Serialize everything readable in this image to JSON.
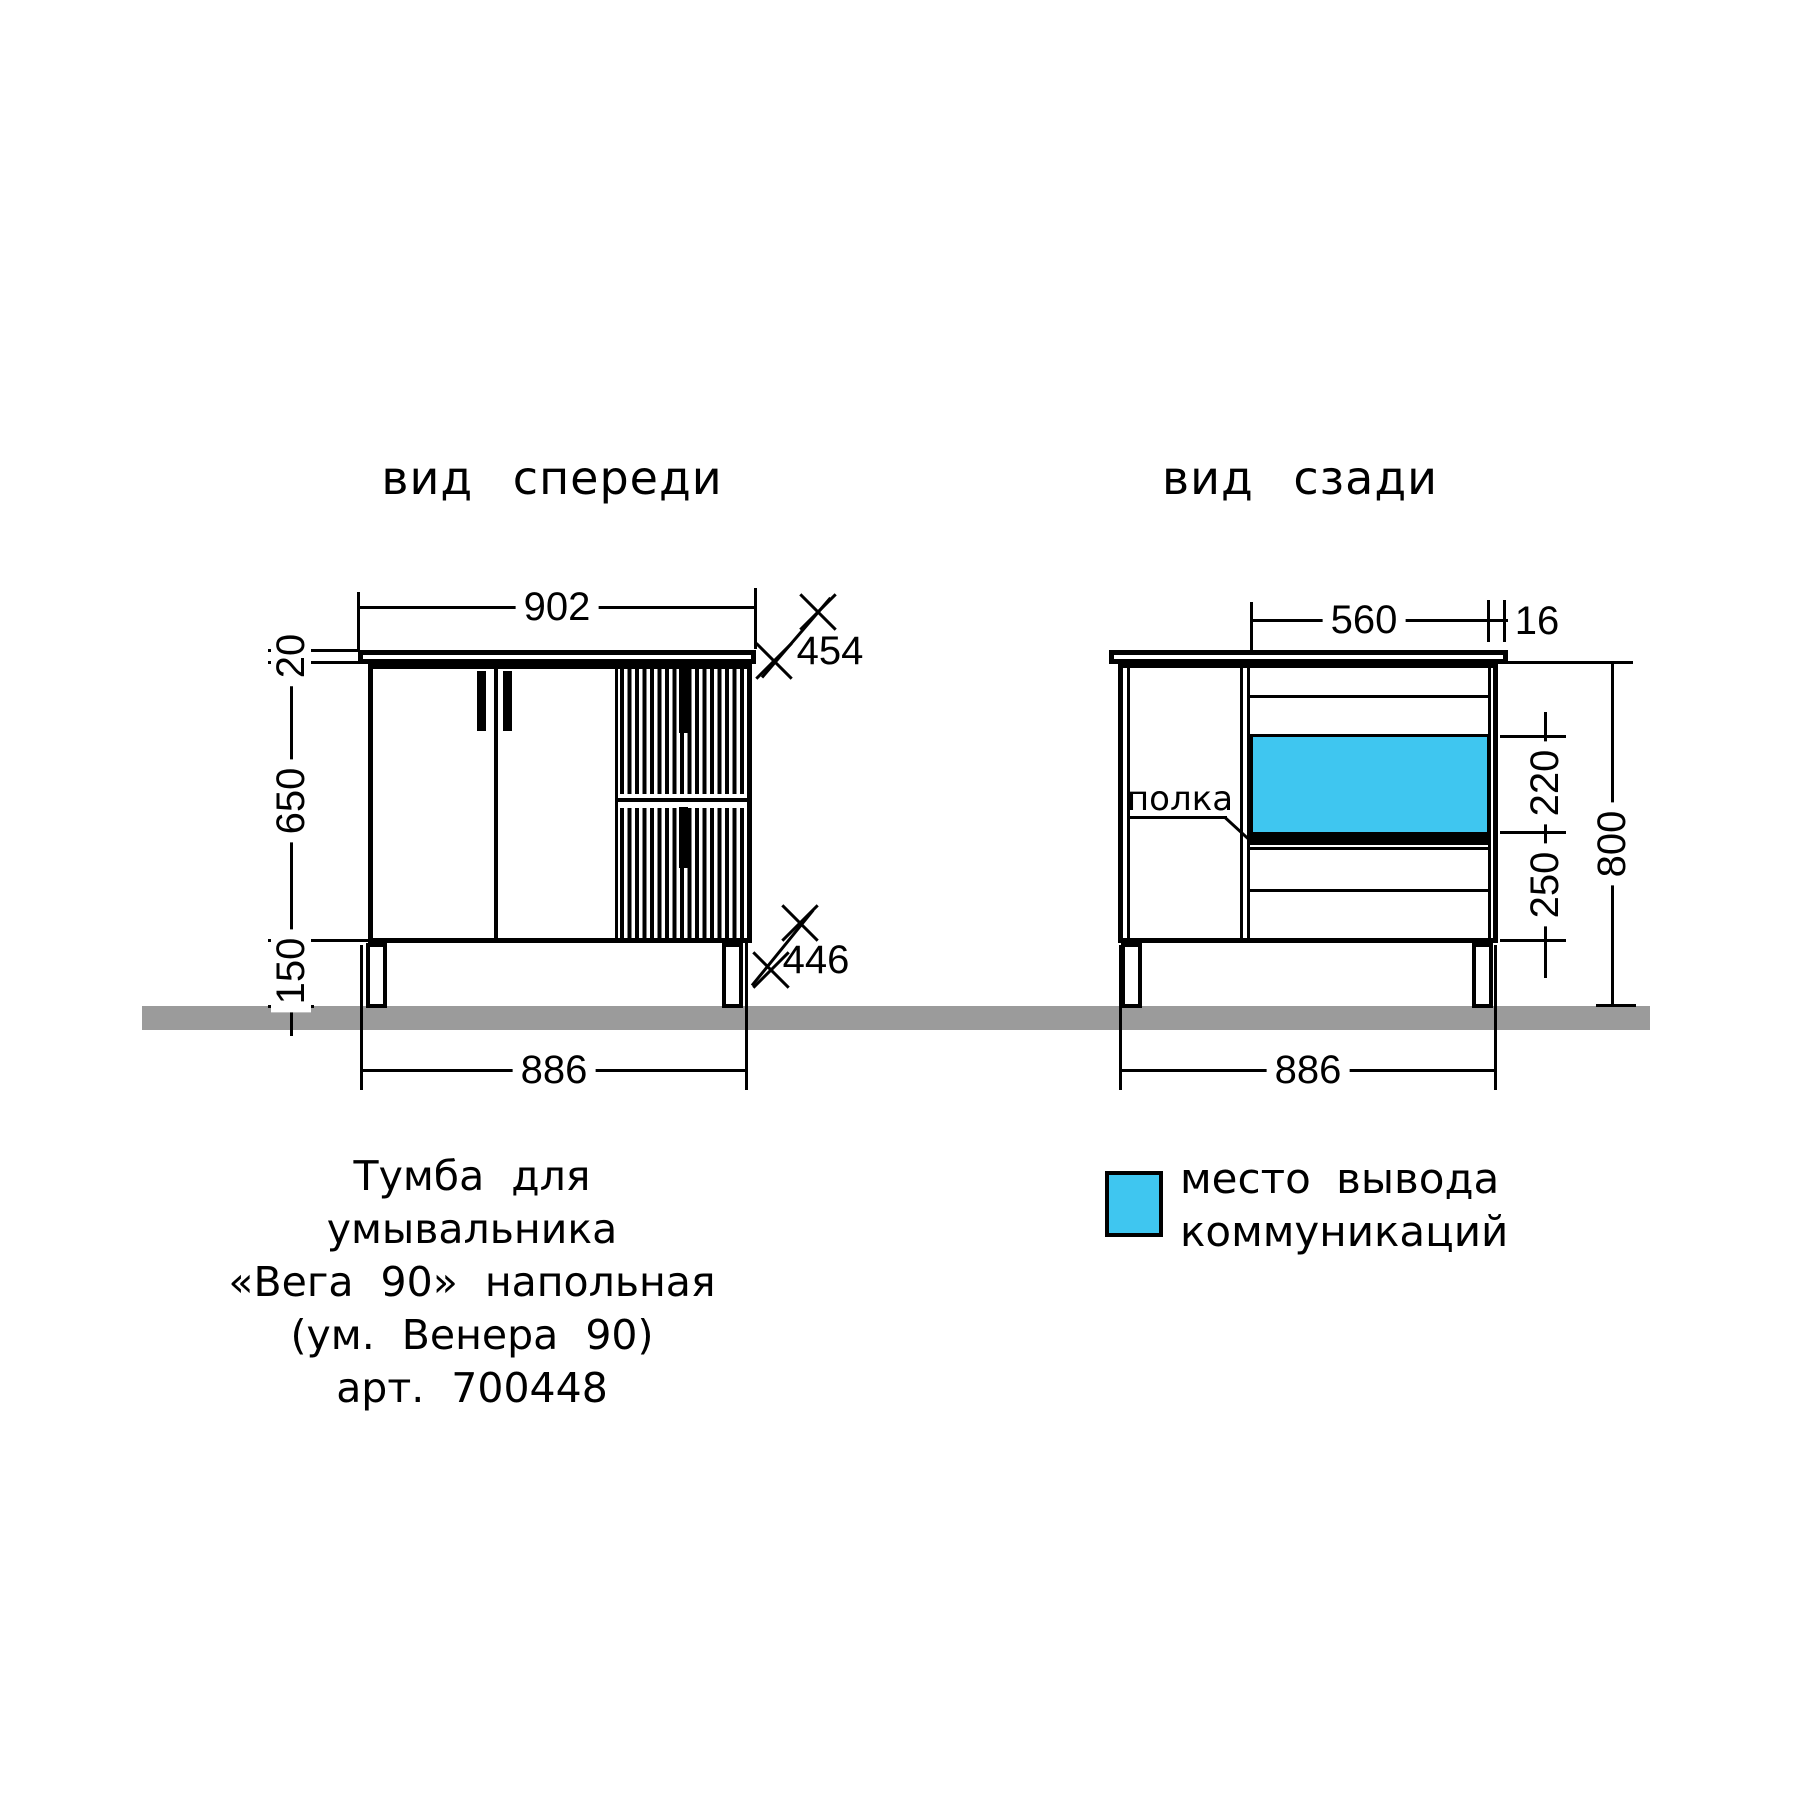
{
  "front": {
    "title": "вид спереди",
    "dims": {
      "top_width": "902",
      "countertop_thickness": "20",
      "body_height": "650",
      "leg_height": "150",
      "bottom_width": "886",
      "diag_top": "454",
      "diag_bottom": "446"
    }
  },
  "rear": {
    "title": "вид сзади",
    "shelf_label": "полка",
    "dims": {
      "inner_width": "560",
      "panel_thickness": "16",
      "comm_zone_height": "220",
      "bottom_zone_height": "250",
      "overall_height": "800",
      "bottom_width": "886"
    }
  },
  "caption": {
    "line1": "Тумба для умывальника",
    "line2": "«Вега 90» напольная",
    "line3": "(ум. Венера 90)",
    "line4": "арт. 700448"
  },
  "legend": {
    "line1": "место вывода",
    "line2": "коммуникаций"
  },
  "colors": {
    "line": "#000000",
    "floor": "#9b9b9b",
    "highlight": "#3fc6f0"
  }
}
